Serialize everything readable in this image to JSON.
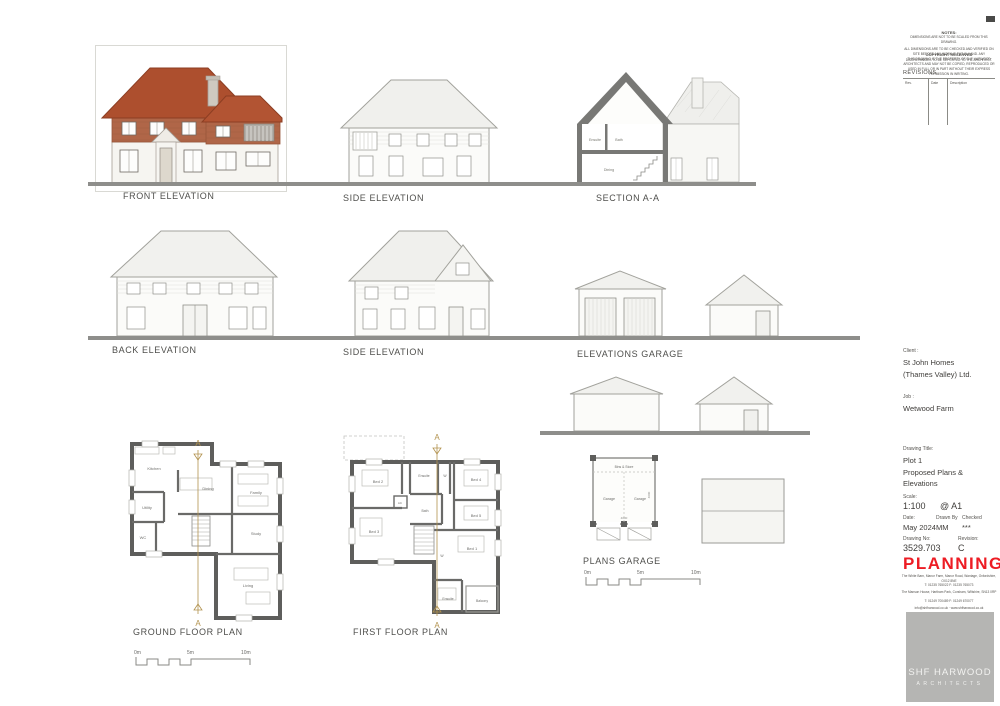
{
  "labels": {
    "front_elevation": "FRONT ELEVATION",
    "side_elevation_top": "SIDE ELEVATION",
    "section_aa": "SECTION A-A",
    "back_elevation": "BACK ELEVATION",
    "side_elevation_mid": "SIDE ELEVATION",
    "elevations_garage": "ELEVATIONS GARAGE",
    "ground_floor_plan": "GROUND FLOOR PLAN",
    "first_floor_plan": "FIRST FLOOR PLAN",
    "plans_garage": "PLANS GARAGE"
  },
  "section_marker": "A",
  "scale_bar": {
    "zero": "0m",
    "five": "5m",
    "ten": "10m"
  },
  "section_rooms": {
    "ensuite": "Ensuite",
    "bath": "Bath",
    "dining": "Dining"
  },
  "ground_floor": {
    "kitchen": "Kitchen",
    "dining": "Dining",
    "family": "Family",
    "utility": "Utility",
    "wc": "WC",
    "study": "Study",
    "living": "Living"
  },
  "first_floor": {
    "bed1": "Bed 1",
    "bed2": "Bed 2",
    "bed3": "Bed 3",
    "bed4": "Bed 4",
    "bed5": "Bed 5",
    "bath": "Bath",
    "ensuite_top": "Ensuite",
    "ensuite_bottom": "Ensuite",
    "wardrobe": "W",
    "ac": "AC",
    "balcony": "Balcony"
  },
  "garage_plan": {
    "bay_left": "Garage",
    "bay_right": "Garage",
    "store": "Bins & Store",
    "dim_width": "4000",
    "dim_depth": "4000"
  },
  "title_block": {
    "notes_title": "NOTES:",
    "notes_line1": "DIMENSIONS ARE NOT TO BE SCALED FROM THIS DRAWING.",
    "notes_line2": "ALL DIMENSIONS ARE TO BE CHECKED AND VERIFIED ON SITE BEFORE ANY WORK IS PUT IN HAND. ANY DISCREPANCIES TO BE REPORTED TO THE ARCHITECT.",
    "copyright_title": "COPYRIGHT RESERVED",
    "copyright_body": "THIS DRAWING IS THE PROPERTY OF SHF HARWOOD ARCHITECTS AND MAY NOT BE COPIED, REPRODUCED OR USED IN FULL OR IN PART WITHOUT THEIR EXPRESS PERMISSION IN WRITING.",
    "revisions_title": "REVISIONS",
    "rev_col_rev": "Rev.",
    "rev_col_date": "Date",
    "rev_col_description": "Description",
    "client_label": "Client :",
    "client_name_1": "St John Homes",
    "client_name_2": "(Thames Valley) Ltd.",
    "job_label": "Job :",
    "job_name": "Wetwood Farm",
    "drawing_title_label": "Drawing Title:",
    "drawing_title_1": "Plot 1",
    "drawing_title_2": "Proposed Plans &",
    "drawing_title_3": "Elevations",
    "scale_label": "Scale:",
    "scale_value": "1:100",
    "scale_sheet": "@ A1",
    "date_label": "Date:",
    "date_value": "May 2024",
    "drawn_by_label": "Drawn By",
    "drawn_by_value": "MM",
    "checked_label": "Checked",
    "checked_value": "***",
    "drawing_no_label": "Drawing No:",
    "drawing_no_value": "3529.703",
    "revision_label": "Revision:",
    "revision_value": "C",
    "stamp": "PLANNING",
    "office1_address": "The White Barn, Manor Farm, Manor Road, Wantage, Oxfordshire, OX12 8NE",
    "office1_phone": "T: 01235 765022          F: 01235 765073",
    "office2_address": "The Manson House, Hartham Park, Corsham, Wiltshire, SN13 0RP",
    "office2_phone": "T: 01249 700489          F: 01249 670077",
    "email_web": "info@shfharwood.co.uk   ·   www.shfharwood.co.uk",
    "logo_line1": "SHF HARWOOD",
    "logo_line2": "ARCHITECTS"
  },
  "colors": {
    "roof_tile": "#ad4f2e",
    "brick": "#b06648",
    "stamp_red": "#ed1c24",
    "section_cut": "#787875",
    "line_gray": "#a2a29c",
    "section_gold": "#b2924e",
    "logo_gray": "#b5b5b3",
    "ground_bar": "#8e8e8b"
  }
}
